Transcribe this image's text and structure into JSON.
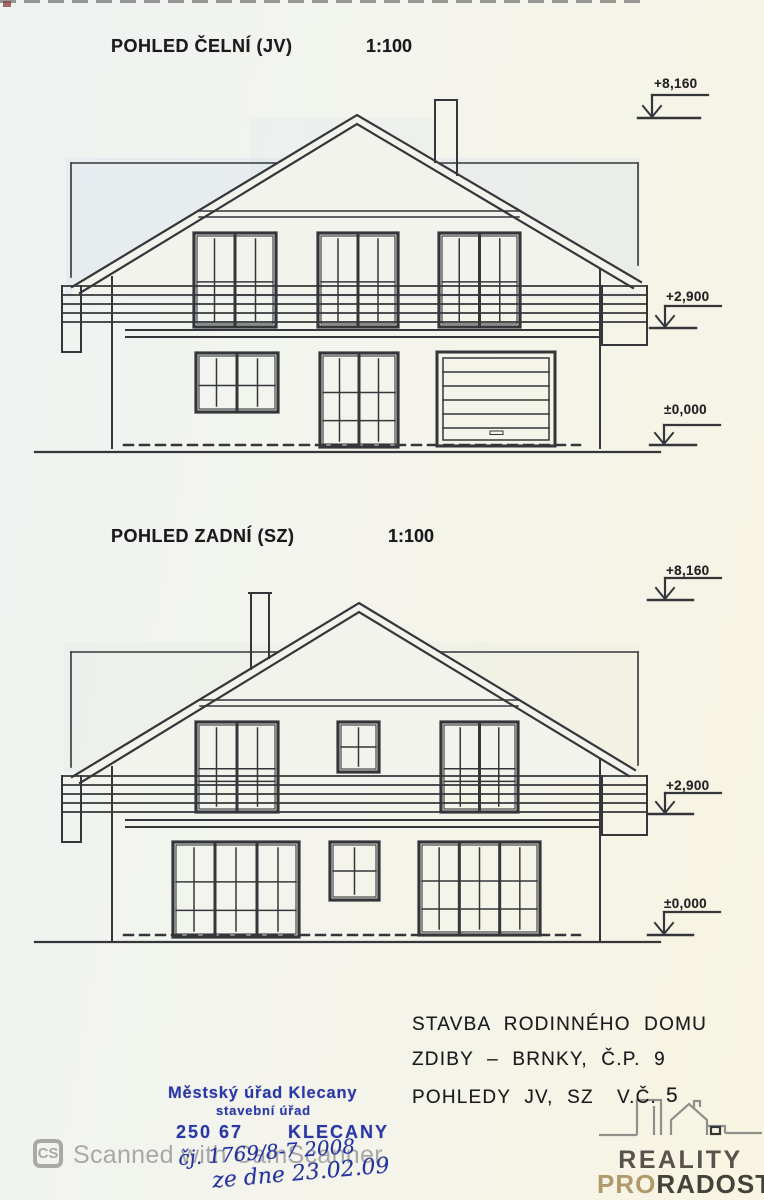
{
  "sheet": {
    "views": [
      {
        "title": "POHLED ČELNÍ (JV)",
        "scale": "1:100",
        "levels": {
          "roof": "+8,160",
          "floor": "+2,900",
          "ground": "±0,000"
        }
      },
      {
        "title": "POHLED ZADNÍ (SZ)",
        "scale": "1:100",
        "levels": {
          "roof": "+8,160",
          "floor": "+2,900",
          "ground": "±0,000"
        }
      }
    ],
    "title_block": {
      "line1": "STAVBA RODINNÉHO DOMU",
      "line2": "ZDIBY – BRNKY, Č.P. 9",
      "line3": "POHLEDY JV, SZ",
      "drawing_number_label": "V.Č.",
      "drawing_number": "5"
    },
    "stamp": {
      "office": "Městský úřad Klecany",
      "department": "stavební úřad",
      "postal_code": "250 67",
      "city": "KLECANY",
      "ink_color": "#2a38a6"
    },
    "handwriting": {
      "line1": "čj. 1769/8-7 2008",
      "line2": "ze dne 23.02.09",
      "ink_color": "#2433a0"
    },
    "watermark": {
      "badge": "CS",
      "text": "Scanned with CamScanner",
      "color": "#a8a8a8"
    },
    "logo": {
      "word1": "REALITY",
      "word2_accent": "PRO",
      "word2_rest": "RADOST",
      "accent_color": "#b09a6c",
      "dark_color": "#45413b"
    }
  }
}
